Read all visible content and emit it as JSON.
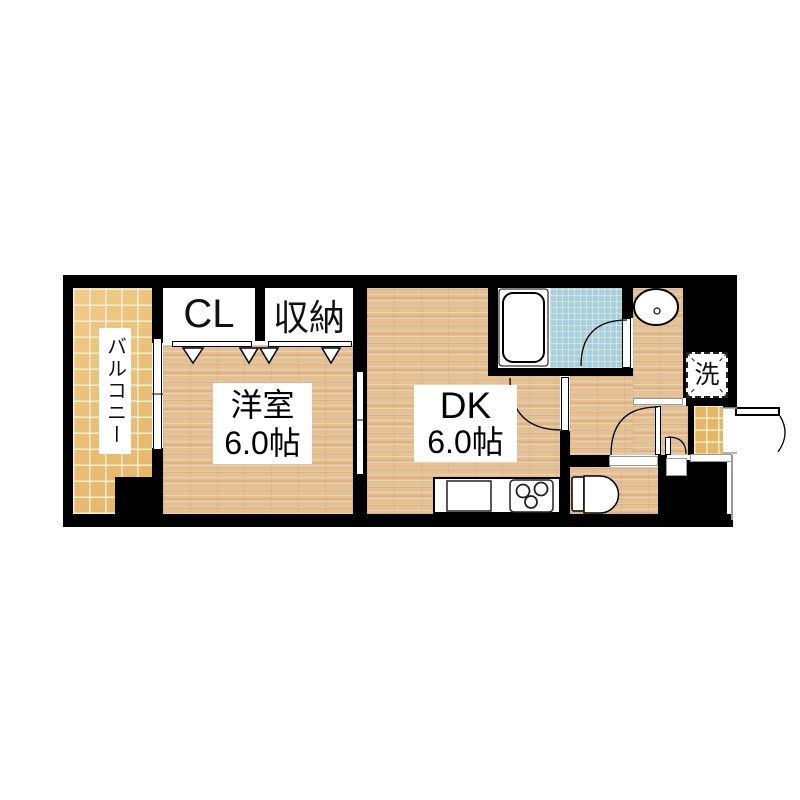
{
  "plan_title": "1DK floor plan",
  "rooms": {
    "balcony": {
      "label": "バルコニー"
    },
    "closet": {
      "label": "CL"
    },
    "storage": {
      "label": "収納"
    },
    "western_room": {
      "name": "洋室",
      "size": "6.0帖"
    },
    "dining_kitchen": {
      "name": "DK",
      "size": "6.0帖"
    },
    "laundry": {
      "label": "洗"
    }
  },
  "colors": {
    "background": "#ffffff",
    "wall": "#000000",
    "wood": "#e4c095",
    "balcony_tile": "#ecbf70",
    "genkan_tile": "#e3b766",
    "bath_tile": "#a8cfda",
    "outline_gray": "#9a9a9a"
  }
}
